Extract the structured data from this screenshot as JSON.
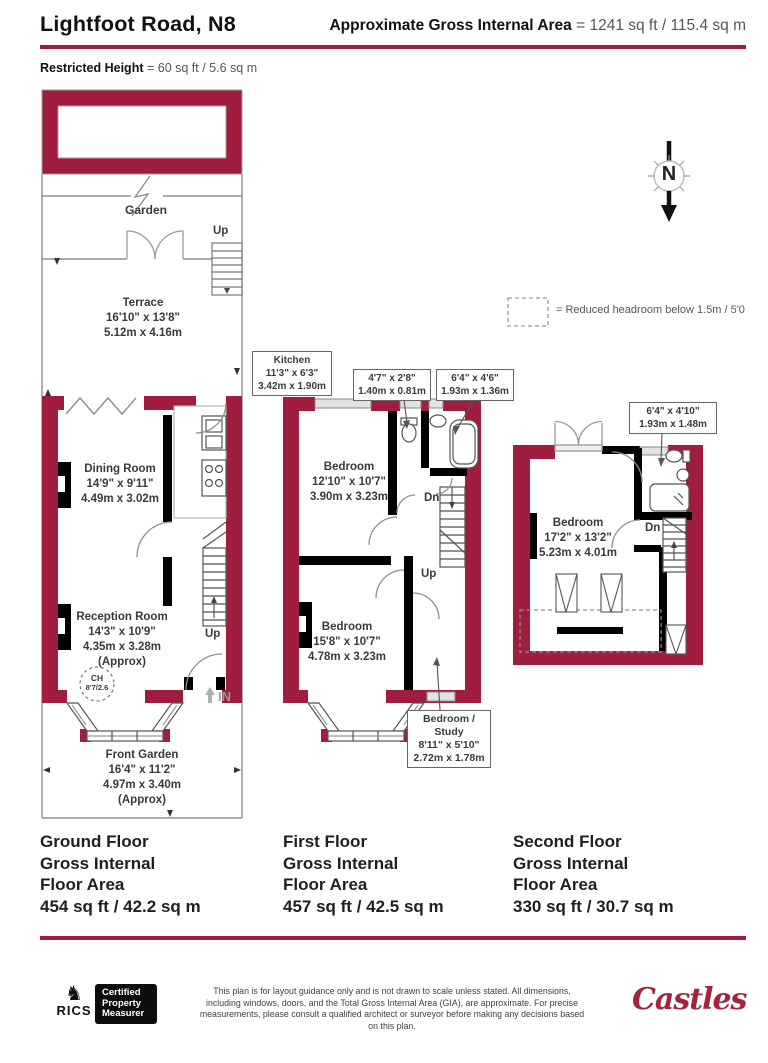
{
  "header": {
    "title": "Lightfoot Road, N8",
    "gia_label": "Approximate Gross Internal Area",
    "gia_value": "= 1241 sq ft / 115.4 sq m",
    "restricted_label": "Restricted Height",
    "restricted_value": "= 60 sq ft / 5.6 sq m"
  },
  "colors": {
    "accent": "#A01D40",
    "internal_wall": "#000000"
  },
  "compass": {
    "north": "N"
  },
  "legend": {
    "text": "= Reduced headroom below 1.5m / 5'0"
  },
  "ground_floor": {
    "garden": "Garden",
    "terrace_up": "Up",
    "terrace": {
      "name": "Terrace",
      "imperial": "16'10\" x 13'8\"",
      "metric": "5.12m x 4.16m"
    },
    "kitchen": {
      "name": "Kitchen",
      "imperial": "11'3\" x 6'3\"",
      "metric": "3.42m x 1.90m"
    },
    "dining": {
      "name": "Dining Room",
      "imperial": "14'9\" x 9'11\"",
      "metric": "4.49m x 3.02m"
    },
    "reception": {
      "name": "Reception Room",
      "imperial": "14'3\" x 10'9\"",
      "metric": "4.35m x 3.28m",
      "approx": "(Approx)"
    },
    "ch_line1": "CH",
    "ch_line2": "8'7/2.6",
    "stairs_up": "Up",
    "entrance": "IN",
    "front_garden": {
      "name": "Front Garden",
      "imperial": "16'4\" x 11'2\"",
      "metric": "4.97m x 3.40m",
      "approx": "(Approx)"
    },
    "area": {
      "l1": "Ground Floor",
      "l2": "Gross Internal",
      "l3": "Floor Area",
      "l4": "454 sq ft / 42.2 sq m"
    }
  },
  "first_floor": {
    "wc_callout": {
      "imperial": "4'7\" x 2'8\"",
      "metric": "1.40m x 0.81m"
    },
    "bath_callout": {
      "imperial": "6'4\" x 4'6\"",
      "metric": "1.93m x 1.36m"
    },
    "bedroom_front": {
      "name": "Bedroom",
      "imperial": "12'10\" x 10'7\"",
      "metric": "3.90m x 3.23m"
    },
    "bedroom_rear": {
      "name": "Bedroom",
      "imperial": "15'8\" x 10'7\"",
      "metric": "4.78m x 3.23m"
    },
    "study_callout": {
      "name_l1": "Bedroom /",
      "name_l2": "Study",
      "imperial": "8'11\" x 5'10\"",
      "metric": "2.72m x 1.78m"
    },
    "dn": "Dn",
    "up": "Up",
    "area": {
      "l1": "First Floor",
      "l2": "Gross Internal",
      "l3": "Floor Area",
      "l4": "457 sq ft / 42.5 sq m"
    }
  },
  "second_floor": {
    "shower_callout": {
      "imperial": "6'4\" x 4'10\"",
      "metric": "1.93m x 1.48m"
    },
    "bedroom": {
      "name": "Bedroom",
      "imperial": "17'2\" x 13'2\"",
      "metric": "5.23m x 4.01m"
    },
    "dn": "Dn",
    "area": {
      "l1": "Second Floor",
      "l2": "Gross Internal",
      "l3": "Floor Area",
      "l4": "330 sq ft / 30.7 sq m"
    }
  },
  "footer": {
    "rics": "RICS",
    "badge_l1": "Certified",
    "badge_l2": "Property",
    "badge_l3": "Measurer",
    "disclaimer": "This plan is for layout guidance only and is not drawn to scale unless stated. All dimensions, including windows, doors, and the Total Gross Internal Area (GIA), are approximate. For precise measurements, please consult a qualified architect or surveyor before making any decisions based on this plan.",
    "brand": "Castles"
  }
}
